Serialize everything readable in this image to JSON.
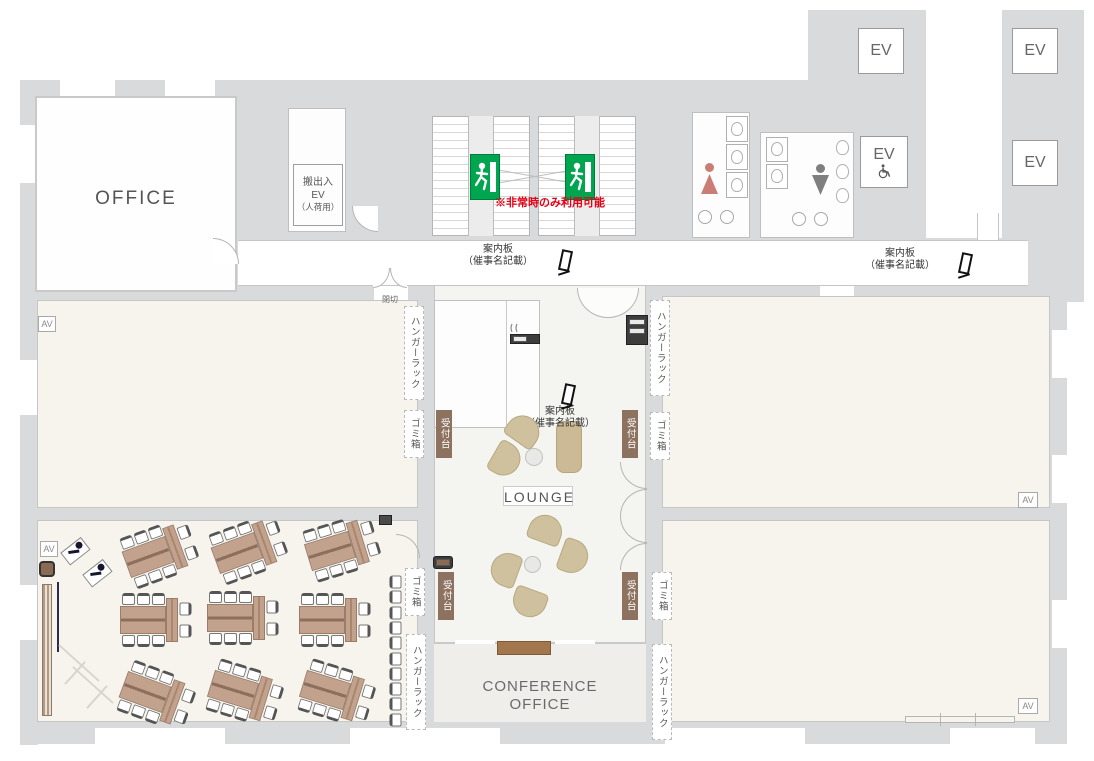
{
  "rooms": {
    "office": "OFFICE",
    "lounge": "LOUNGE",
    "conference": [
      "CONFERENCE",
      "OFFICE"
    ]
  },
  "labels": {
    "service_ev": [
      "搬出入",
      "EV",
      "（人荷用）"
    ],
    "emergency_note": "※非常時のみ利用可能",
    "info_board": [
      "案内板",
      "（催事名記載）"
    ],
    "hanger_rack": "ハンガーラック",
    "trash_bin": "ゴミ箱",
    "reception_desk": "受付台",
    "closed_partition": "閉切",
    "av": "AV",
    "ev": "EV"
  },
  "icons": {
    "emergency_exit": "non-emergency-exit-sign",
    "wheelchair": "wheelchair-accessible-elevator",
    "woman": "womens-restroom",
    "man": "mens-restroom",
    "info_stand": "information-sign-stand"
  },
  "colors": {
    "wall": "#d9dadb",
    "room_cream": "#f7f4ee",
    "lounge_bg": "#f4f4f1",
    "table_brown": "#c2a28d",
    "sofa_tan": "#cfc09e",
    "reception_bg": "#8d7260",
    "exit_green": "#00a54f",
    "alert_red": "#e60014",
    "women_pink": "#c97d75",
    "men_gray": "#7f7f7f",
    "counter_brown": "#a3774e"
  }
}
